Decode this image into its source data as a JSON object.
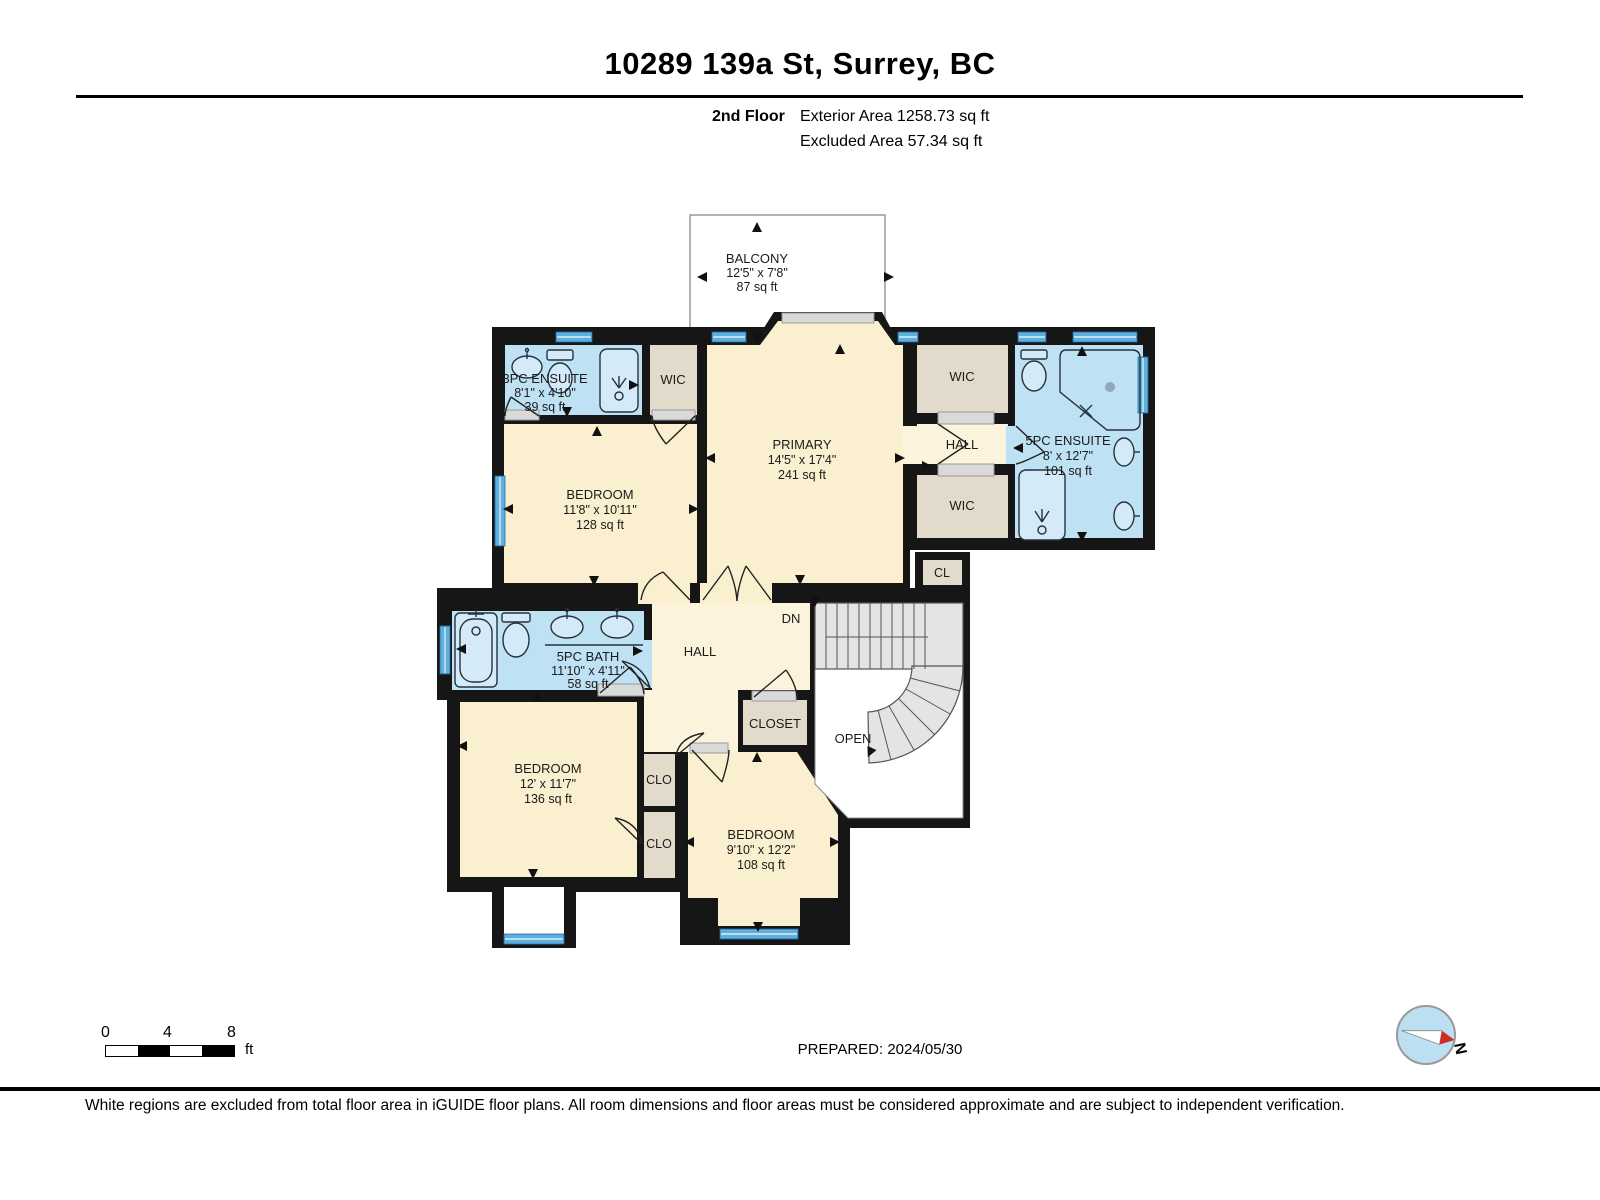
{
  "header": {
    "address": "10289 139a St, Surrey, BC",
    "floor_label": "2nd Floor",
    "exterior_area": "Exterior Area 1258.73 sq ft",
    "excluded_area": "Excluded Area 57.34 sq ft"
  },
  "plan": {
    "balcony": {
      "name": "BALCONY",
      "dims": "12'5\" x 7'8\"",
      "area": "87 sq ft"
    },
    "ensuite3": {
      "name": "3PC ENSUITE",
      "dims": "8'1\" x 4'10\"",
      "area": "39 sq ft"
    },
    "wic_top_left": {
      "name": "WIC"
    },
    "primary": {
      "name": "PRIMARY",
      "dims": "14'5\" x 17'4\"",
      "area": "241 sq ft"
    },
    "wic_right_top": {
      "name": "WIC"
    },
    "hall_right": {
      "name": "HALL"
    },
    "wic_right_bottom": {
      "name": "WIC"
    },
    "ensuite5": {
      "name": "5PC ENSUITE",
      "dims": "8' x 12'7\"",
      "area": "101 sq ft"
    },
    "cl": {
      "name": "CL"
    },
    "bedroom_top_left": {
      "name": "BEDROOM",
      "dims": "11'8\" x 10'11\"",
      "area": "128 sq ft"
    },
    "bath5": {
      "name": "5PC BATH",
      "dims": "11'10\" x 4'11\"",
      "area": "58 sq ft"
    },
    "hall_center": {
      "name": "HALL"
    },
    "stairs_label": "DN",
    "open_label": "OPEN",
    "closet": {
      "name": "CLOSET"
    },
    "clo_top": {
      "name": "CLO"
    },
    "clo_bottom": {
      "name": "CLO"
    },
    "bedroom_bottom_left": {
      "name": "BEDROOM",
      "dims": "12' x 11'7\"",
      "area": "136 sq ft"
    },
    "bedroom_bottom_mid": {
      "name": "BEDROOM",
      "dims": "9'10\" x 12'2\"",
      "area": "108 sq ft"
    }
  },
  "footer": {
    "scale": {
      "t0": "0",
      "t4": "4",
      "t8": "8",
      "unit": "ft"
    },
    "prepared": "PREPARED: 2024/05/30",
    "compass_label": "N",
    "disclaimer": "White regions are excluded from total floor area in iGUIDE floor plans. All room dimensions and floor areas must be considered approximate and are subject to independent verification."
  },
  "colors": {
    "wall": "#161616",
    "room_fill": "#FAF0CF",
    "hall_fill": "#FBF3DC",
    "closet_fill": "#E2DACA",
    "bath_fill": "#BFE1F4",
    "window_blue": "#5FAEDC",
    "stairs_fill": "#E4E4E4",
    "compass_fill": "#BDDFF2",
    "needle_red": "#D22B20"
  }
}
